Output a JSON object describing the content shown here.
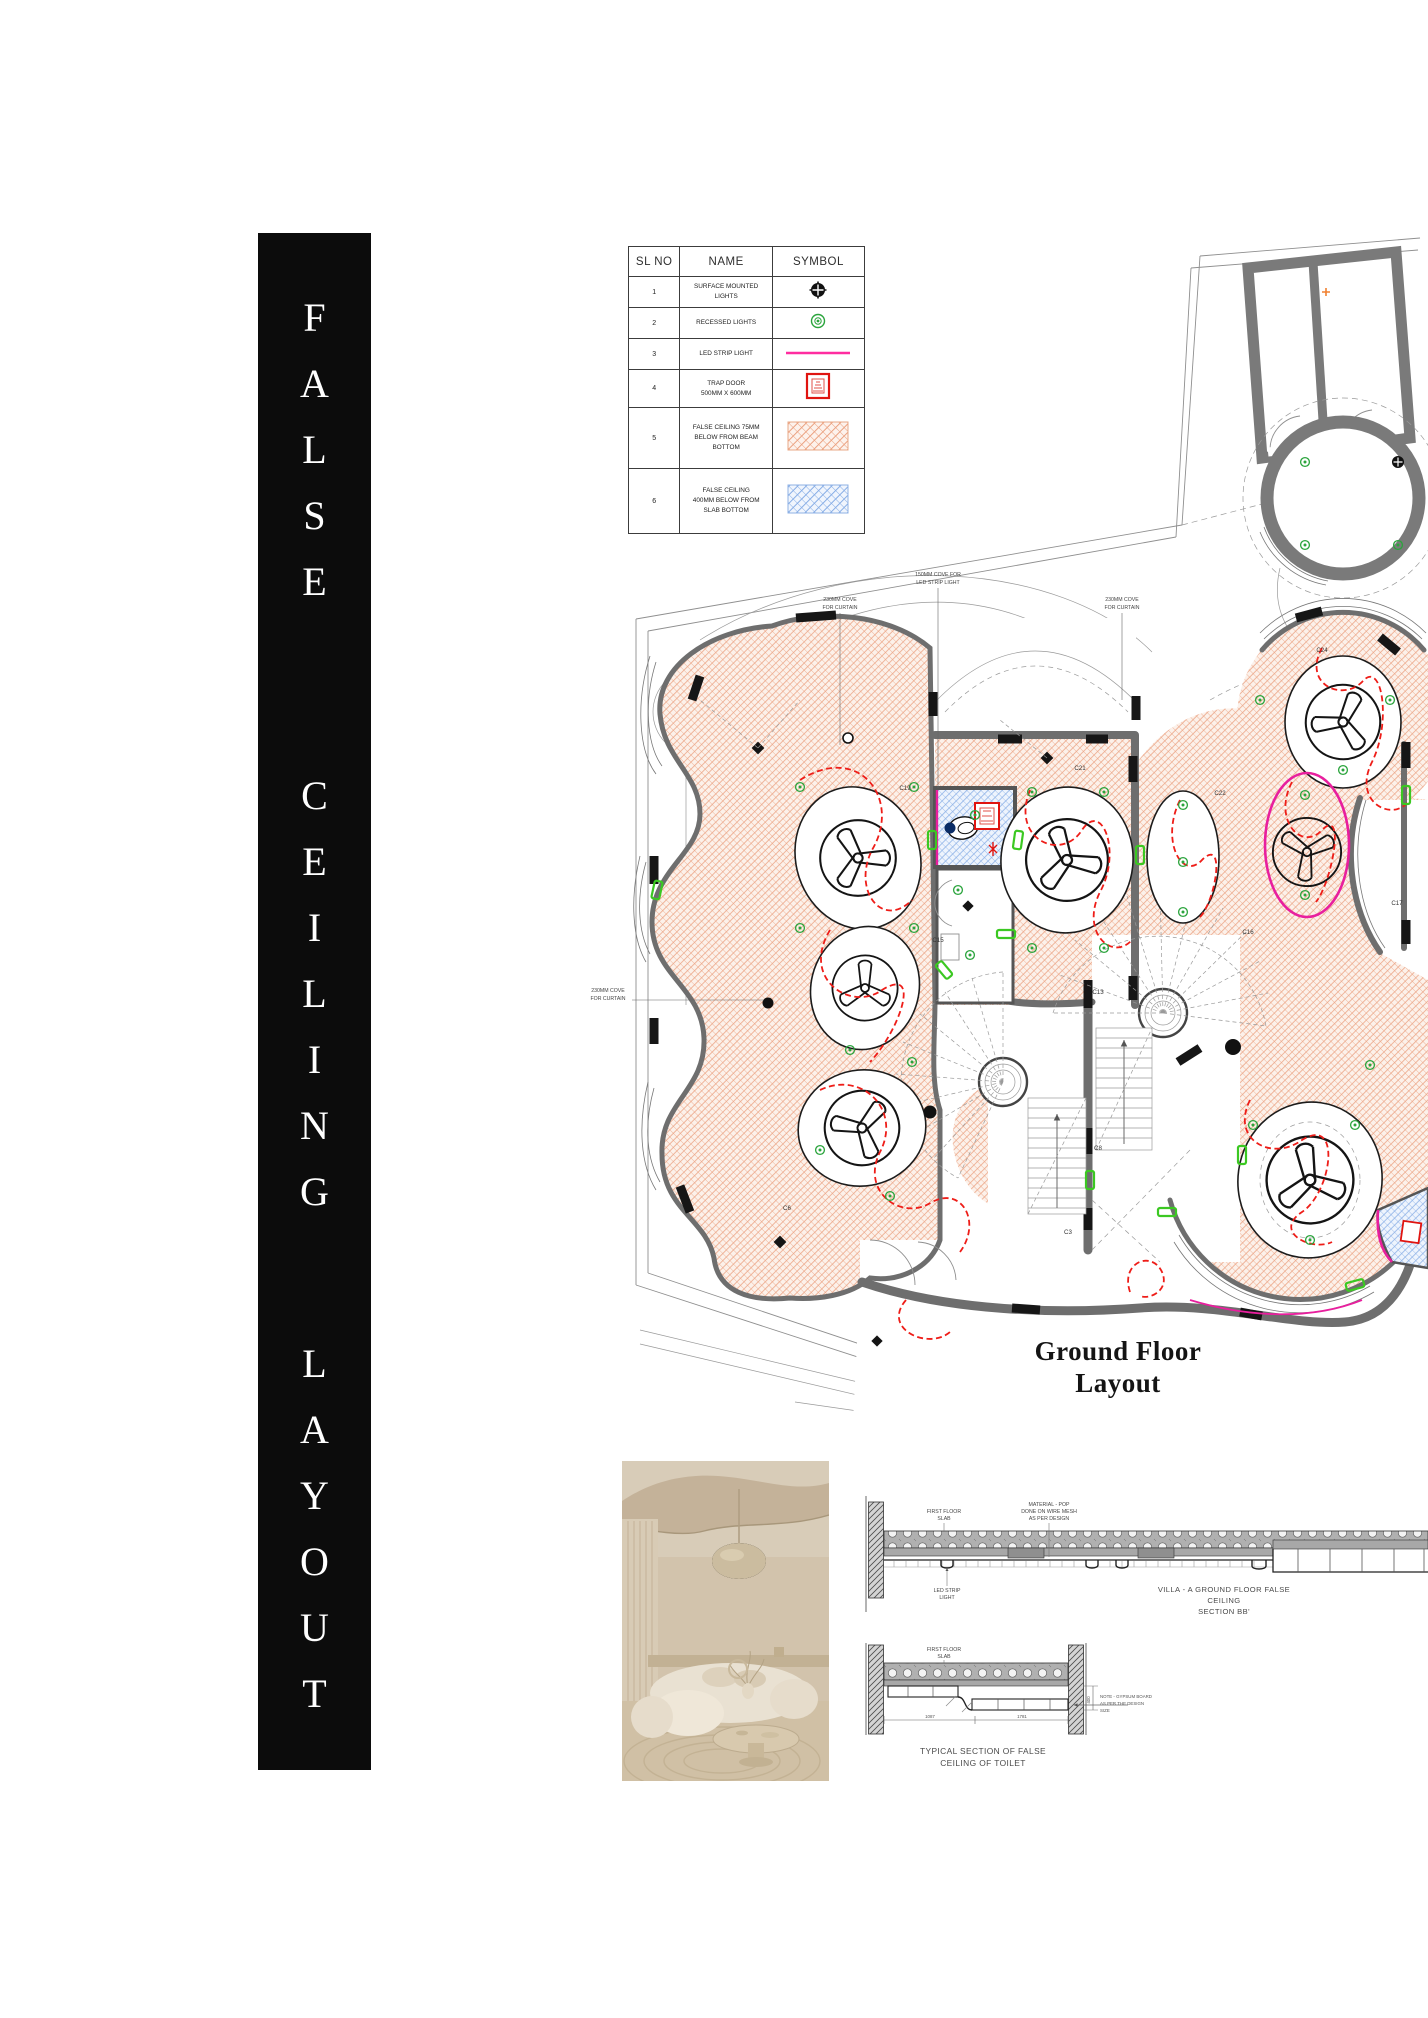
{
  "banner": {
    "words": [
      "FALSE",
      "CEILING",
      "LAYOUT"
    ],
    "bg": "#0c0c0c",
    "text_color": "#ffffff"
  },
  "legend": {
    "headers": [
      "SL NO",
      "NAME",
      "SYMBOL"
    ],
    "rows": [
      {
        "no": "1",
        "name": "SURFACE MOUNTED\nLIGHTS",
        "symbol": "surface-mounted-light"
      },
      {
        "no": "2",
        "name": "RECESSED LIGHTS",
        "symbol": "recessed-light"
      },
      {
        "no": "3",
        "name": "LED STRIP LIGHT",
        "symbol": "led-strip-light"
      },
      {
        "no": "4",
        "name": "TRAP DOOR\n500MM X 600MM",
        "symbol": "trap-door"
      },
      {
        "no": "5",
        "name": "FALSE CEILING 75MM\nBELOW FROM BEAM\nBOTTOM",
        "symbol": "peach-hatch"
      },
      {
        "no": "6",
        "name": "FALSE CEILING\n400MM BELOW FROM\nSLAB BOTTOM",
        "symbol": "blue-hatch"
      }
    ]
  },
  "plan": {
    "title_line1": "Ground Floor",
    "title_line2": "Layout",
    "labels": {
      "cove_top_1a": "230MM COVE",
      "cove_top_1b": "FOR CURTAIN",
      "cove_led_a": "150MM COVE FOR",
      "cove_led_b": "LED STRIP LIGHT",
      "cove_top_2a": "230MM COVE",
      "cove_top_2b": "FOR CURTAIN",
      "cove_left_a": "230MM COVE",
      "cove_left_b": "FOR CURTAIN"
    },
    "c_labels": [
      {
        "t": "C3"
      },
      {
        "t": "C6"
      },
      {
        "t": "C8"
      },
      {
        "t": "C13"
      },
      {
        "t": "C15"
      },
      {
        "t": "C16"
      },
      {
        "t": "C17"
      },
      {
        "t": "C19"
      },
      {
        "t": "C21"
      },
      {
        "t": "C22"
      },
      {
        "t": "C24"
      }
    ],
    "colors": {
      "peach": "#eba281",
      "blue": "#88aee6",
      "wall": "#6e6e6e",
      "led_red": "#ee1d18",
      "magenta": "#e81f9e",
      "green": "#2aa43c"
    }
  },
  "sections": {
    "bb": {
      "label_slab_a": "FIRST FLOOR",
      "label_slab_b": "SLAB",
      "label_mat_a": "MATERIAL - POP",
      "label_mat_b": "DONE ON WIRE MESH",
      "label_mat_c": "AS PER DESIGN",
      "label_led_a": "LED STRIP",
      "label_led_b": "LIGHT",
      "title_a": "VILLA - A GROUND FLOOR  FALSE",
      "title_b": "CEILING",
      "title_c": "SECTION BB'"
    },
    "toilet": {
      "label_slab_a": "FIRST FLOOR",
      "label_slab_b": "SLAB",
      "dim1": "1087",
      "dim2": "1781",
      "dim3": "400",
      "note_a": "NOTE - GYPSUM BOARD",
      "note_b": "AS PER THE DESIGN",
      "note_c": "SIZE",
      "title_a": "TYPICAL SECTION OF FALSE",
      "title_b": "CEILING OF TOILET"
    }
  }
}
